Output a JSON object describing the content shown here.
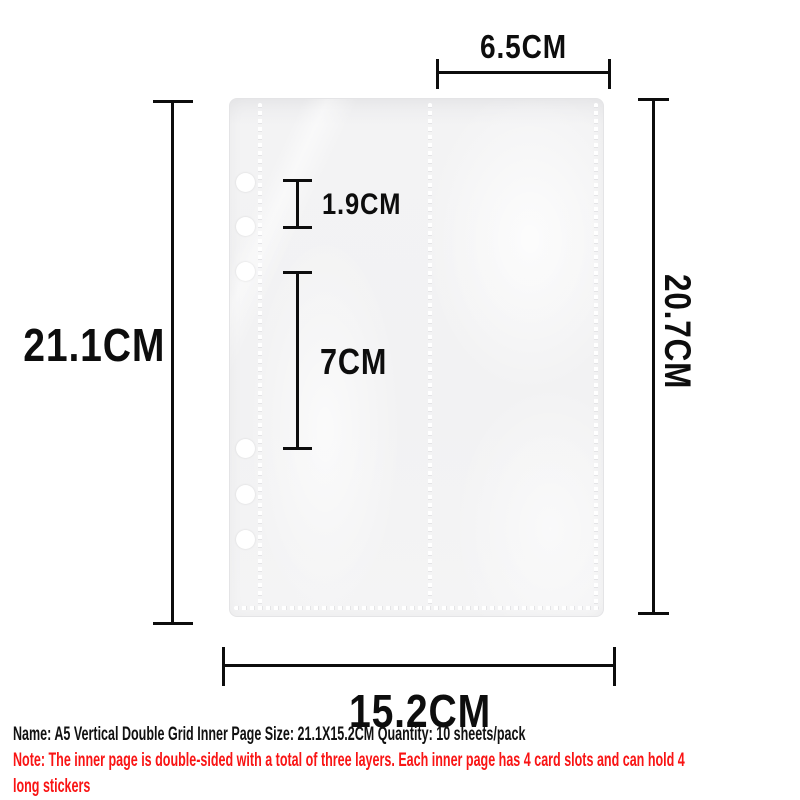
{
  "sheet": {
    "holes_count": 6,
    "base_color": "#f2f2f3"
  },
  "dimensions": {
    "top_width": "6.5CM",
    "left_height": "21.1CM",
    "right_height": "20.7CM",
    "hole_gap": "1.9CM",
    "hole_group_gap": "7CM",
    "bottom_width": "15.2CM"
  },
  "caption": {
    "name_line": "Name: A5 Vertical Double Grid Inner Page Size: 21.1X15.2CM Quantity: 10 sheets/pack",
    "note_line_1": "Note: The inner page is double-sided with a total of three layers. Each inner page has 4 card slots and can hold 4",
    "note_line_2": "long stickers"
  },
  "colors": {
    "annotation_black": "#0d0d0d",
    "note_red": "#f91414",
    "background": "#ffffff"
  }
}
